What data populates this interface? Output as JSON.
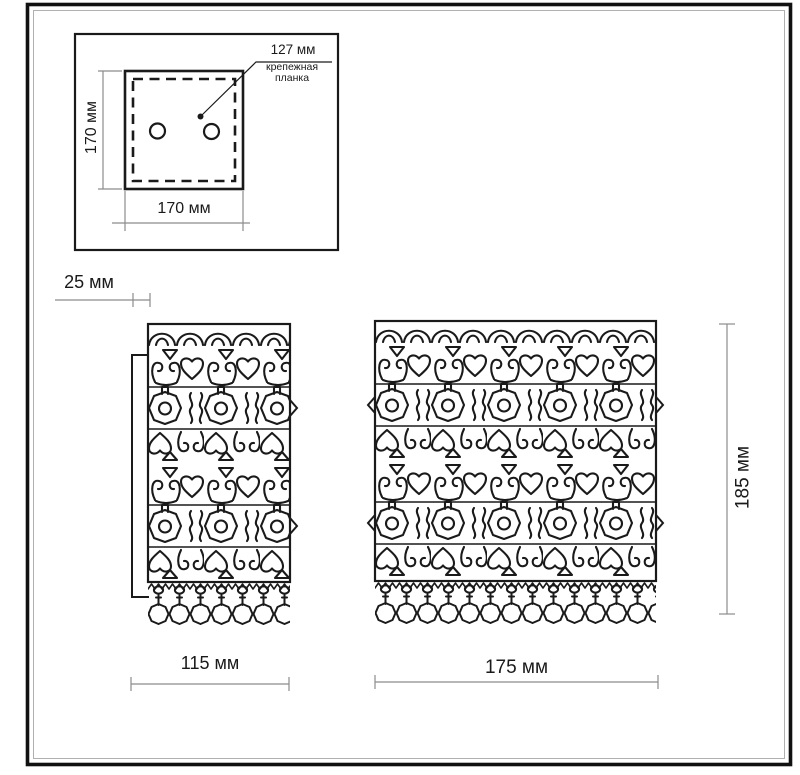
{
  "drawing": {
    "title": "wall-sconce dimensional drawing",
    "inset": {
      "bracket_width_label": "127 мм",
      "bracket_name_line1": "крепежная",
      "bracket_name_line2": "планка",
      "plate_height_label": "170 мм",
      "plate_width_label": "170 мм"
    },
    "side_view": {
      "depth_label": "25 мм",
      "width_label": "115 мм"
    },
    "front_view": {
      "width_label": "175 мм",
      "height_label": "185 мм"
    },
    "colors": {
      "line": "#1a1a1a",
      "dimension_line": "#8c8c8c",
      "background": "#ffffff"
    }
  }
}
